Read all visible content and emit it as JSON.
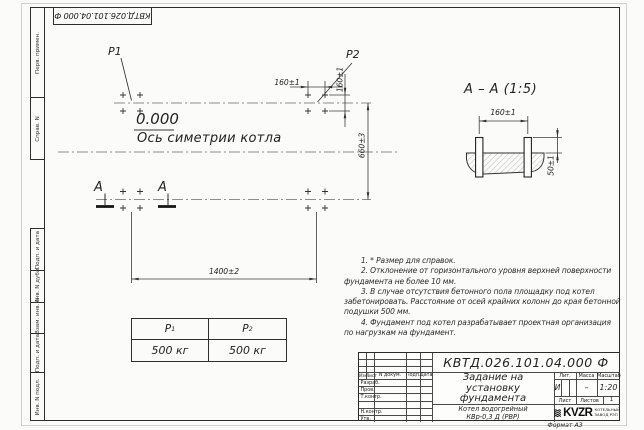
{
  "frame": {
    "top_stamp": "КВТД.026.101.04.000 Ф",
    "margin_top": [
      "Перв. примен.",
      "Справ. N"
    ],
    "margin_bottom": [
      "Подп. и дата",
      "Инв. N дубл.",
      "Взам. инв. N",
      "Подп. и дата",
      "Инв. N подл."
    ],
    "format_note": "Формат А3"
  },
  "plan": {
    "p1": "P1",
    "p2": "P2",
    "elevation": "0.000",
    "axis_label": "Ось симетрии котла",
    "section_letter": "А",
    "dim_length": "1400±2",
    "dim_width": "660±3",
    "dim_bolt_x": "160±1",
    "dim_bolt_y": "160±1"
  },
  "section_view": {
    "title": "А – А (1:5)",
    "dim_spacing": "160±1",
    "dim_height": "50±1"
  },
  "load_table": {
    "headers": [
      {
        "base": "P",
        "sub": "1"
      },
      {
        "base": "P",
        "sub": "2"
      }
    ],
    "values": [
      "500 кг",
      "500 кг"
    ]
  },
  "notes": {
    "lines": [
      "1. * Размер для справок.",
      "2. Отклонение от горизонтального уровня верхней поверхности",
      "фундамента не более 10 мм.",
      "3. В случае отсутствия бетонного пола площадку под котел",
      "забетонировать. Расстояние от осей крайних колонн до края бетонной",
      "подушки 500 мм.",
      "4. Фундамент под котел разрабатывает проектная организация",
      "по нагрузкам на фундамент."
    ]
  },
  "title_block": {
    "doc_number": "КВТД.026.101.04.000 Ф",
    "doc_title": [
      "Задание на",
      "установку",
      "фундамента"
    ],
    "product": [
      "Котел водогрейный",
      "КВр-0,3 Д (РВР)"
    ],
    "cols": {
      "izm": "Изм.",
      "list": "Лист",
      "doc": "N докум.",
      "sign": "Подп.",
      "date": "Дата"
    },
    "sig_rows": [
      "Разраб.",
      "Пров.",
      "Т.контр.",
      "Н.контр.",
      "Утв."
    ],
    "lit_label": "Лит.",
    "lit_value": "И",
    "mass_label": "Масса",
    "mass_value": "–",
    "scale_label": "Масштаб",
    "scale_value": "1:20",
    "sheet_label": "Лист",
    "sheets_label": "Листов",
    "sheets_value": "1",
    "logo_text": "KVZR",
    "logo_caption": [
      "КОТЕЛЬНЫЙ",
      "ЗАВОД РЭП"
    ]
  }
}
